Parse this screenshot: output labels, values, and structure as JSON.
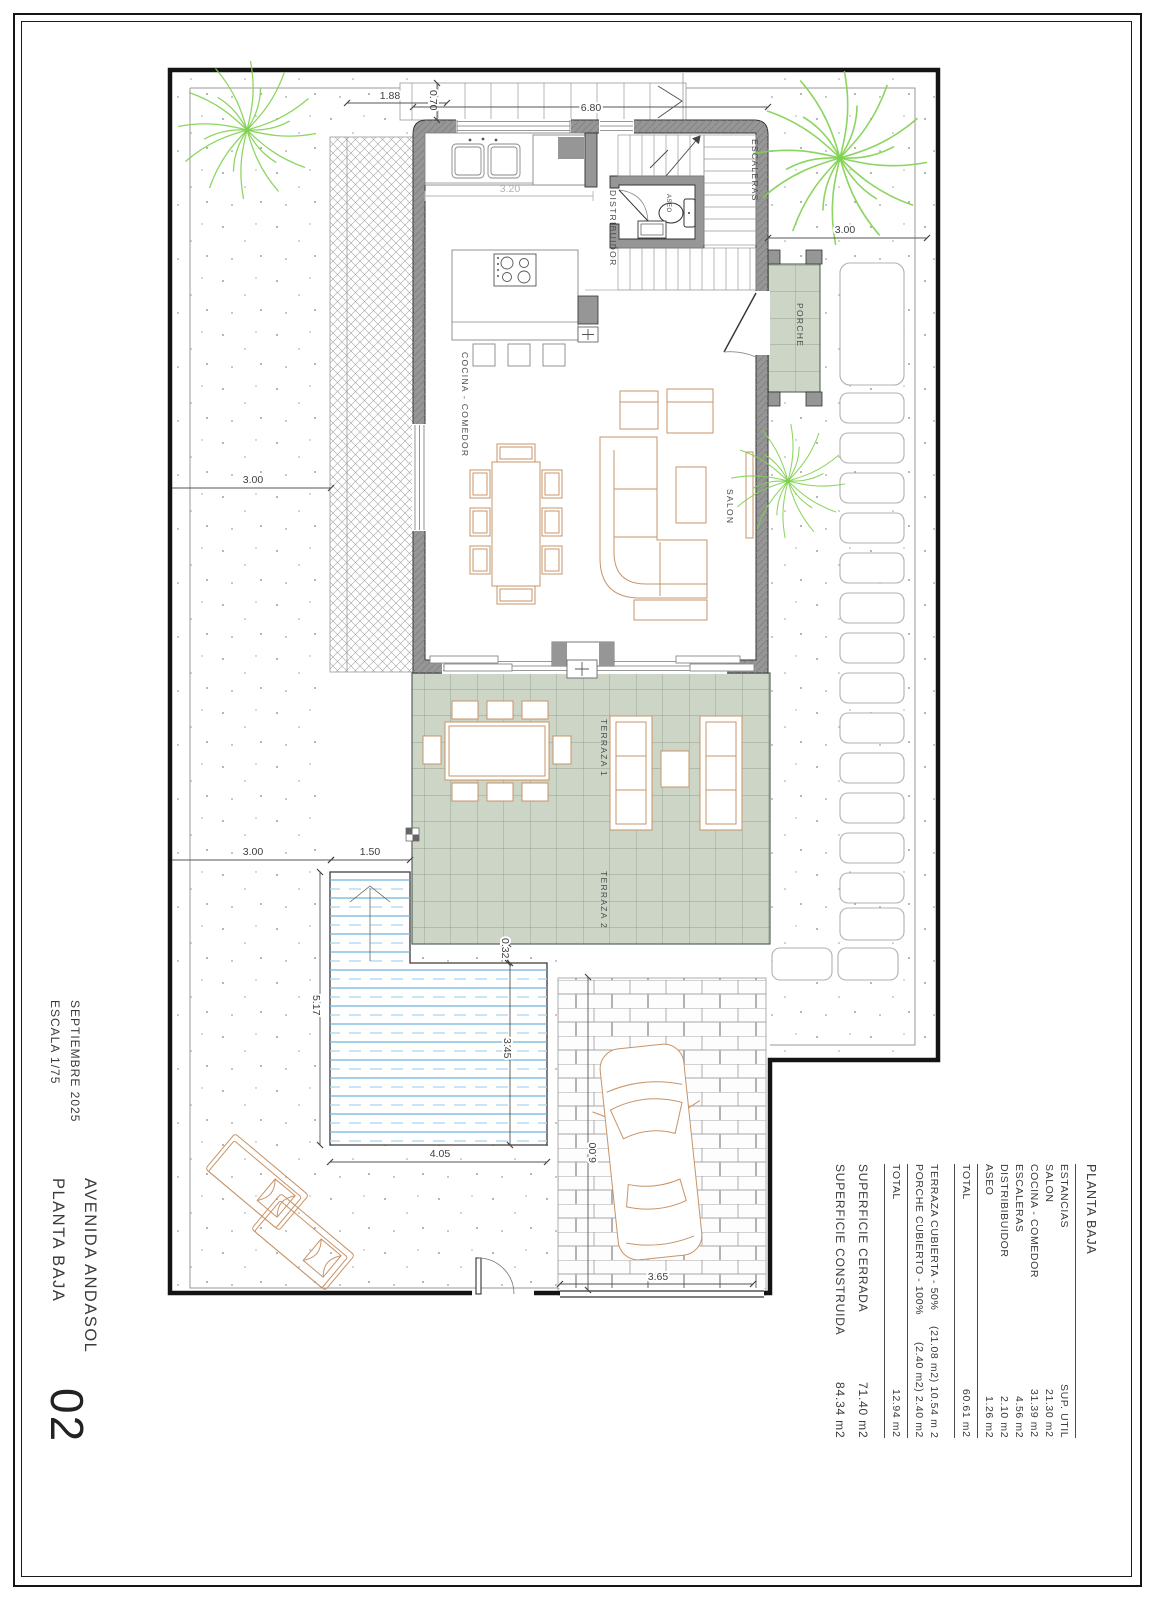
{
  "title_block": {
    "date": "SEPTIEMBRE 2025",
    "scale": "ESCALA 1/75",
    "street": "AVENIDA ANDASOL",
    "plan_name": "PLANTA BAJA",
    "sheet_number": "02"
  },
  "room_labels": {
    "cocina": "COCINA - COMEDOR",
    "salon": "SALON",
    "distribuidor": "DISTRIBUIDOR",
    "escaleras": "ESCALERAS",
    "aseo": "ASEO",
    "porche": "PORCHE",
    "terraza1": "TERRAZA 1",
    "terraza2": "TERRAZA 2"
  },
  "dims": {
    "d188": "1.88",
    "d070": "0.70",
    "d680": "6.80",
    "d320": "3.20",
    "d300_top": "3.00",
    "d300_mid": "3.00",
    "d300_low": "3.00",
    "d150": "1.50",
    "d032": "0.32",
    "d517": "5.17",
    "d345": "3.45",
    "d405": "4.05",
    "d600": "6.00",
    "d365": "3.65"
  },
  "area_table": {
    "title": "PLANTA BAJA",
    "col_room": "ESTANCIAS",
    "col_area": "SUP. UTIL",
    "rows": [
      {
        "name": "SALON",
        "area": "21.30 m2"
      },
      {
        "name": "COCINA - COMEDOR",
        "area": "31.39 m2"
      },
      {
        "name": "ESCALERAS",
        "area": "4.56 m2"
      },
      {
        "name": "DISTRIBIBUIDOR",
        "area": "2.10 m2"
      },
      {
        "name": "ASEO",
        "area": "1.26 m2"
      }
    ],
    "total_label": "TOTAL",
    "total_area": "60.61 m2",
    "outdoor_rows": [
      {
        "name": "TERRAZA CUBIERTA - 50%",
        "area": "(21.08 m2) 10.54 m 2"
      },
      {
        "name": "PORCHE CUBIERTO - 100%",
        "area": "(2.40 m2) 2.40 m2"
      }
    ],
    "outdoor_total_label": "TOTAL",
    "outdoor_total_area": "12.94 m2",
    "summary_rows": [
      {
        "name": "SUPERFICIE CERRADA",
        "area": "71.40 m2"
      },
      {
        "name": "SUPERFICIE CONSTRUIDA",
        "area": "84.34 m2"
      }
    ]
  },
  "colors": {
    "wall-gray": "#969696",
    "terrace-green": "#ccd5c6",
    "pool-blue": "#6db3dc",
    "pool-blue-light": "#a9d4ec",
    "furniture-tan": "#c79468",
    "palm-green": "#7ed04f",
    "boundary-black": "#141414"
  }
}
